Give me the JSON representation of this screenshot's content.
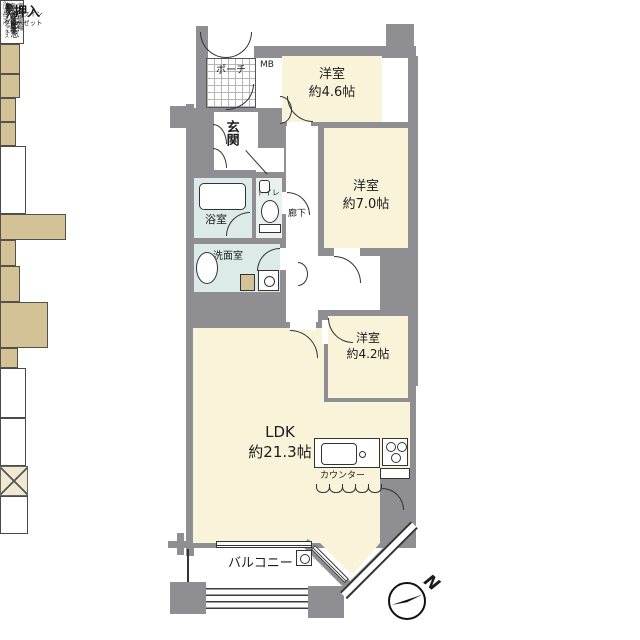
{
  "rooms": {
    "porch": {
      "label": "ポーチ"
    },
    "mb": {
      "label": "MB"
    },
    "bedroom1": {
      "name": "洋室",
      "size": "約4.6帖"
    },
    "bedroom2": {
      "name": "洋室",
      "size": "約7.0帖"
    },
    "bedroom3": {
      "name": "洋室",
      "size": "約4.2帖"
    },
    "ldk": {
      "name": "LDK",
      "size": "約21.3帖"
    },
    "entrance": {
      "label": "玄関"
    },
    "bath": {
      "label": "浴室"
    },
    "toilet": {
      "label": "トイレ"
    },
    "corridor": {
      "label": "廊下"
    },
    "washroom": {
      "label": "洗面室"
    },
    "oshiire": {
      "label": "押入"
    },
    "wic": {
      "line1": "ウォークイン",
      "line2": "クローゼット"
    },
    "balcony": {
      "label": "バルコニー"
    }
  },
  "storage": {
    "closet_hall": "クローゼット",
    "shoes_box": "シューズボックス",
    "closet_small": "クローゼット",
    "monoire_hall": "物入",
    "monoire_wic": "物入",
    "monoire_left_top": "物",
    "monoire_left_bottom": "入"
  },
  "features": {
    "outdoor_unit_top": "室外機置場",
    "outdoor_unit_mid": "室外機置場",
    "outdoor_unit_bottom": "室外機置場",
    "bay_window_1": "出窓",
    "bay_window_2": "出窓",
    "counter": "カウンター",
    "compass_n": "N"
  },
  "colors": {
    "wall": "#8e8e93",
    "room_cream": "#f8f3d9",
    "wet_blue": "#dcebe7",
    "closet_tan": "#d3c295"
  }
}
